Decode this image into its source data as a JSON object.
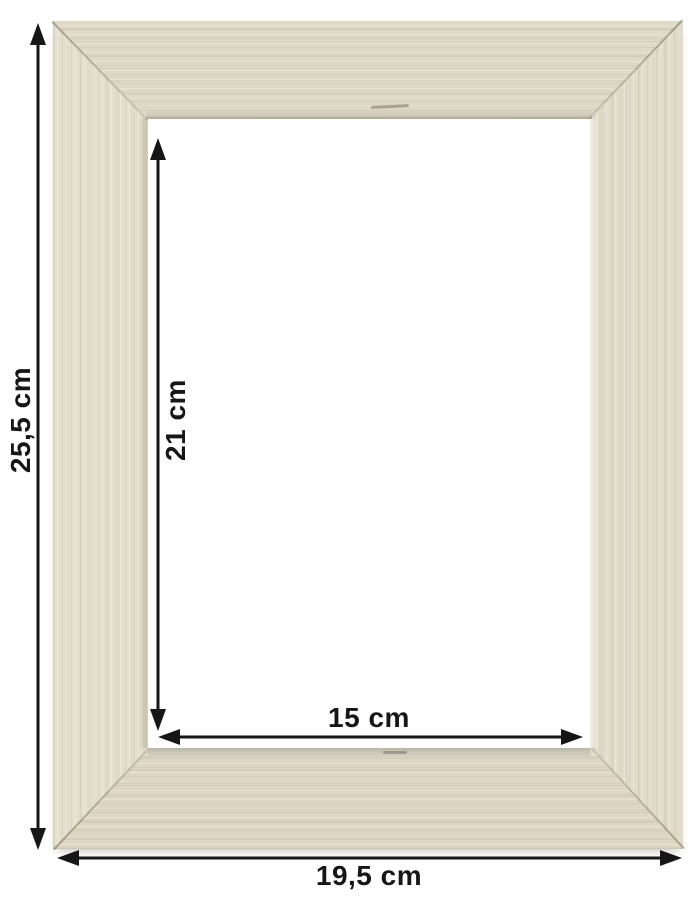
{
  "image": {
    "subject": "cream-white wooden picture frame with mitered corners, front view",
    "style": "product dimension diagram"
  },
  "measurements": {
    "outer_height": "25,5 cm",
    "outer_width": "19,5 cm",
    "inner_height": "21 cm",
    "inner_width": "15 cm"
  },
  "colors": {
    "background": "#ffffff",
    "annotation": "#161616",
    "wood_top_bar": "#ded8c6",
    "wood_bottom_bar": "#dcd6c3",
    "wood_left_bar": "#e4dfcd",
    "wood_right_bar": "#e1dcc9",
    "inner_lip_shadow": "#b8b5a9",
    "opening": "#ffffff"
  }
}
